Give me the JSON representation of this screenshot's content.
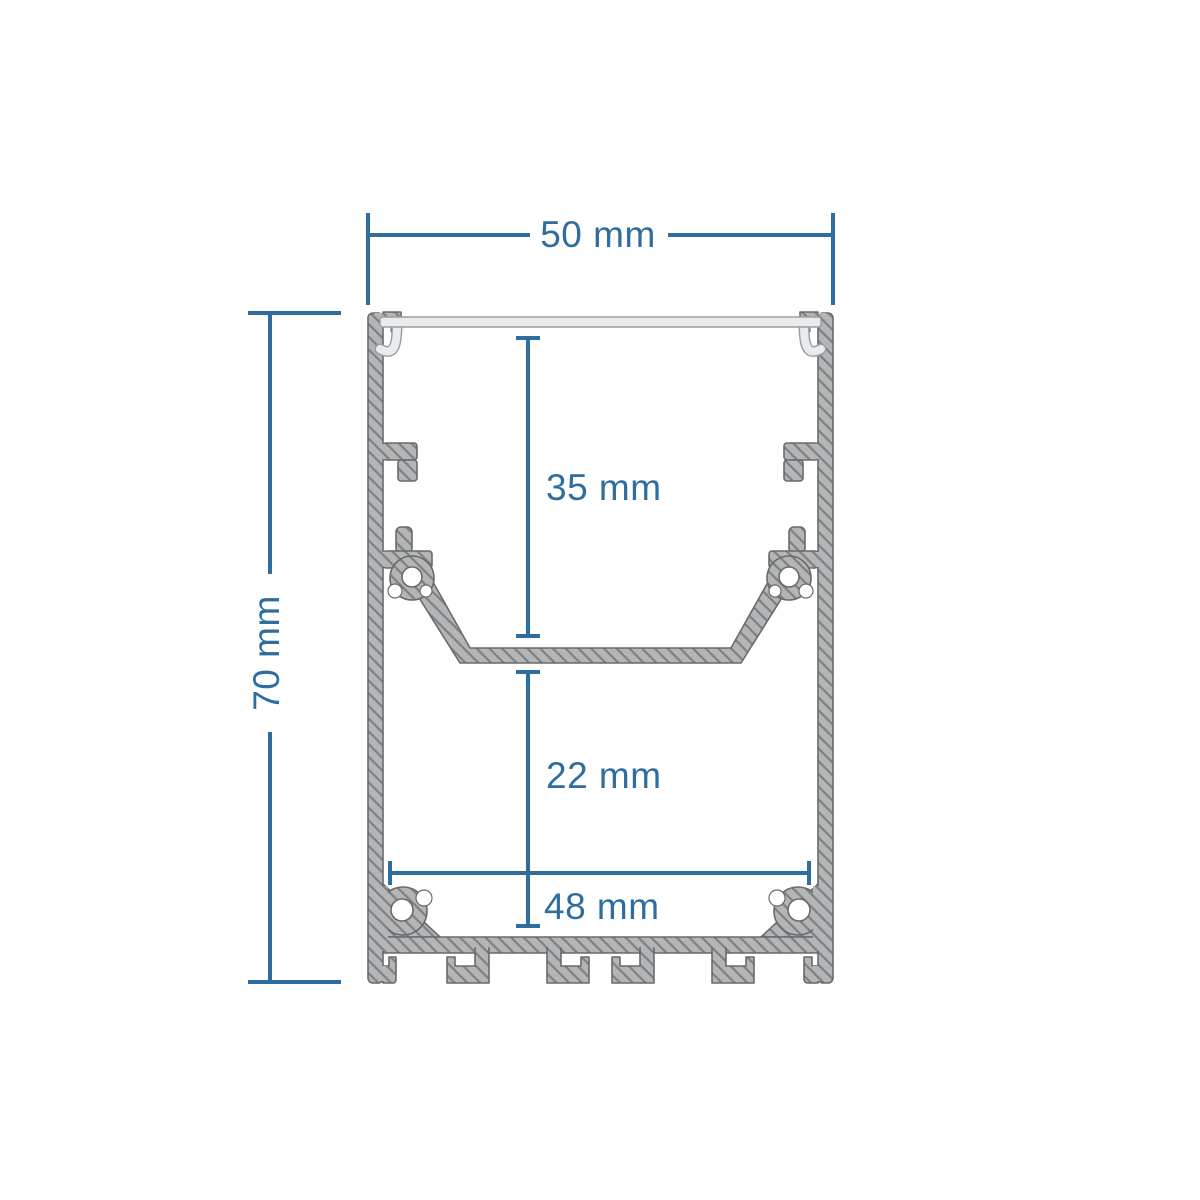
{
  "drawing": {
    "name": "led-aluminium-profile-cross-section",
    "dimensions": {
      "outer_width": {
        "label": "50 mm"
      },
      "outer_height": {
        "label": "70 mm"
      },
      "upper_depth": {
        "label": "35 mm"
      },
      "lower_depth": {
        "label": "22 mm"
      },
      "inner_width": {
        "label": "48 mm"
      }
    },
    "colors": {
      "dimension_accent": "#2e6d9e",
      "profile_fill": "#b3b5b7",
      "profile_hatch": "#7e8082",
      "profile_outline": "#686a6c",
      "cover_fill": "#e9ebed",
      "cover_outline": "#9aa0a4",
      "background": "#ffffff"
    }
  }
}
